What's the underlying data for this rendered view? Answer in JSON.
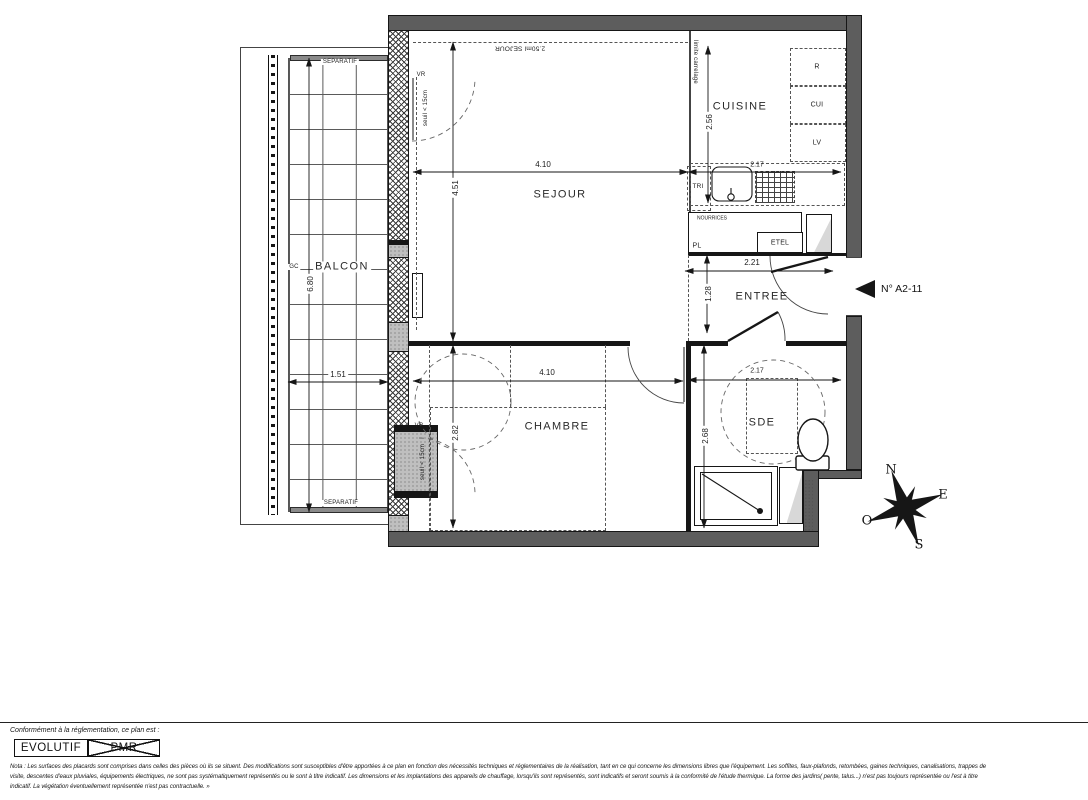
{
  "unit": {
    "label": "N° A2-11"
  },
  "rooms": {
    "sejour": "SEJOUR",
    "cuisine": "CUISINE",
    "entree": "ENTREE",
    "chambre": "CHAMBRE",
    "sde": "SDE",
    "balcon": "BALCON"
  },
  "dims": {
    "sejour_width": "4.10",
    "sejour_depth": "4.51",
    "cuisine_width": "2.17",
    "cuisine_depth": "2.56",
    "entree_width": "2.21",
    "entree_depth": "1.28",
    "chambre_width": "4.10",
    "chambre_depth": "2.82",
    "sde_width": "2.17",
    "sde_depth": "2.68",
    "balcon_length": "6.80",
    "balcon_width": "1.51"
  },
  "annotations": {
    "separatif_top": "SEPARATIF",
    "separatif_bottom": "SEPARATIF",
    "gc": "GC",
    "vr_sejour": "VR",
    "vr_chambre": "VR",
    "seuil_sejour": "seuil < 15cm",
    "seuil_chambre": "seuil < 15cm",
    "limite_carrelage": "limite carrelage",
    "sejour_surface": "2.50ml SEJOUR",
    "tri": "TRI",
    "nourrices": "NOURRICES",
    "pl": "PL",
    "etel": "ETEL",
    "refrigerateur": "R",
    "cuisson": "CUI",
    "lave_vaisselle": "LV"
  },
  "compass": {
    "north": "N",
    "east": "E",
    "south": "S",
    "west": "O"
  },
  "legend": {
    "intro": "Conformément à la réglementation, ce plan est :",
    "evolutif": "EVOLUTIF",
    "pmr": "PMR",
    "nota_line1": "Nota : Les surfaces des placards sont comprises dans celles des pièces où ils se situent. Des modifications sont susceptibles d'être apportées à ce plan en fonction des nécessités techniques et réglementaires de la réalisation, tant en ce qui concerne les dimensions libres que l'équipement.  Les soffites, faux-plafonds, retombées, gaines techniques, canalisations, trappes de",
    "nota_line2": "visite, descentes d'eaux pluviales, équipements électriques, ne sont pas systématiquement représentés ou le sont à titre indicatif. Les dimensions et les implantations des appareils de chauffage, lorsqu'ils sont représentés, sont indicatifs et seront soumis à la conformité de l'étude thermique.  La forme des jardins( pente, talus...) n'est pas toujours représentée ou l'est à titre",
    "nota_line3": "indicatif. La végétation éventuellement représentée n'est pas contractuelle. »"
  },
  "colors": {
    "wall_fill": "#5d5d5d",
    "line": "#161616",
    "gray_block": "#bfbfbf"
  }
}
